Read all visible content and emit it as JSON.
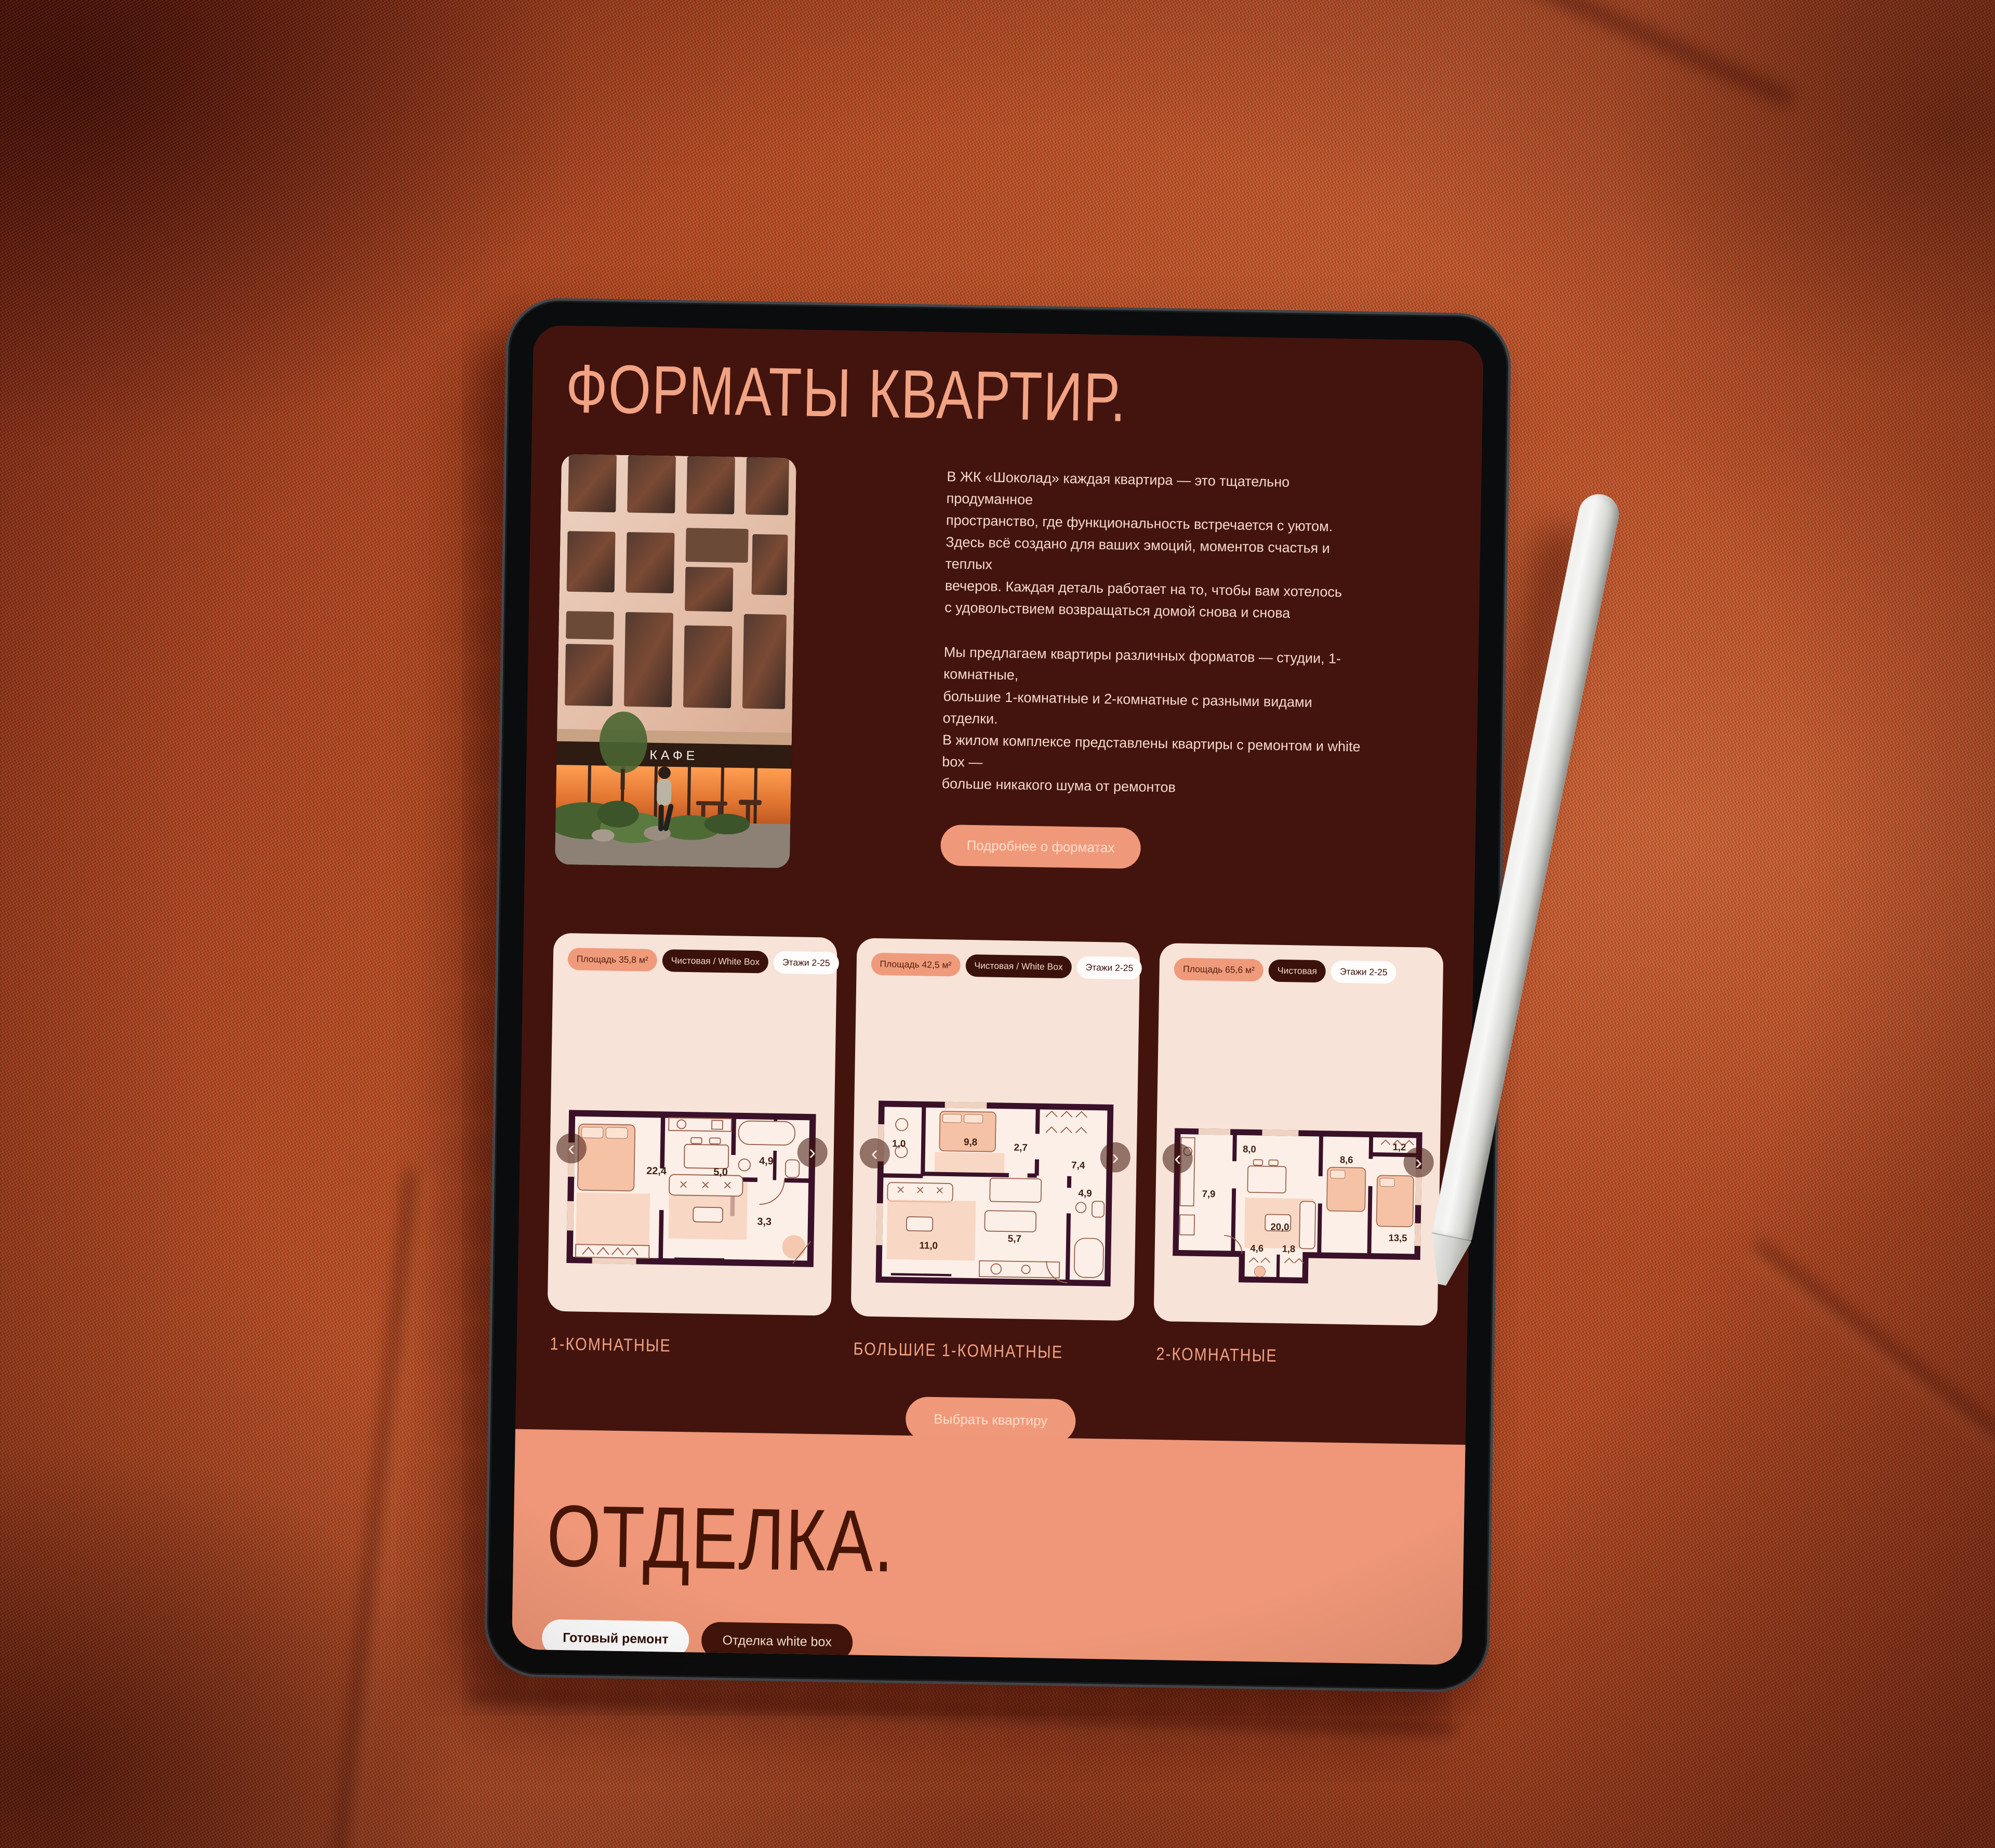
{
  "scene": {
    "device": "tablet-mockup",
    "stylus": "white-stylus",
    "background": "rust-fabric-couch"
  },
  "colors": {
    "screen_bg": "#43140E",
    "accent_salmon": "#F0997A",
    "heading_salmon": "#F2A384",
    "body_text": "#F6D9C8",
    "card_bg": "#F8E3D8",
    "tag_dark_bg": "#3A120B",
    "tag_white_bg": "#FFFDFC",
    "finish_band_bg": "#EF9778",
    "finish_heading": "#471507",
    "plan_walls": "#3A1129",
    "fabric_orange": "#C75A30"
  },
  "screen": {
    "formats_section": {
      "title": "ФОРМАТЫ КВАРТИР.",
      "photo_sign": "КАФЕ",
      "intro": "В ЖК «Шоколад» каждая квартира — это тщательно продуманное\nпространство, где функциональность встречается с уютом.\nЗдесь всё создано для ваших эмоций, моментов счастья и теплых\nвечеров. Каждая деталь работает на то, чтобы вам хотелось\nс удовольствием возвращаться домой снова и снова",
      "intro2": "Мы предлагаем квартиры различных форматов — студии, 1-комнатные,\nбольшие 1-комнатные и 2-комнатные с разными видами отделки.\nВ жилом комплексе представлены квартиры с ремонтом и white box —\nбольше никакого шума от ремонтов",
      "details_button": "Подробнее о форматах",
      "choose_button": "Выбрать квартиру",
      "carousel": {
        "prev": "‹",
        "next": "›"
      },
      "cards": [
        {
          "area": "Площадь 35,8 м²",
          "finish": "Чистовая / White Box",
          "floors": "Этажи 2-25",
          "type_label": "1-КОМНАТНЫЕ",
          "rooms": [
            "22,4",
            "5,0",
            "4,9",
            "3,3"
          ]
        },
        {
          "area": "Площадь 42,5 м²",
          "finish": "Чистовая / White Box",
          "floors": "Этажи 2-25",
          "type_label": "БОЛЬШИЕ 1-КОМНАТНЫЕ",
          "rooms": [
            "1,0",
            "9,8",
            "2,7",
            "7,4",
            "5,7",
            "4,9",
            "11,0"
          ]
        },
        {
          "area": "Площадь 65,6 м²",
          "finish": "Чистовая",
          "floors": "Этажи 2-25",
          "type_label": "2-КОМНАТНЫЕ",
          "rooms": [
            "8,0",
            "7,9",
            "1,2",
            "8,6",
            "20,0",
            "13,5",
            "4,6",
            "1,8"
          ]
        }
      ]
    },
    "finish_section": {
      "title": "ОТДЕЛКА.",
      "chips": [
        {
          "label": "Готовый ремонт"
        },
        {
          "label": "Отделка white box"
        }
      ]
    }
  }
}
